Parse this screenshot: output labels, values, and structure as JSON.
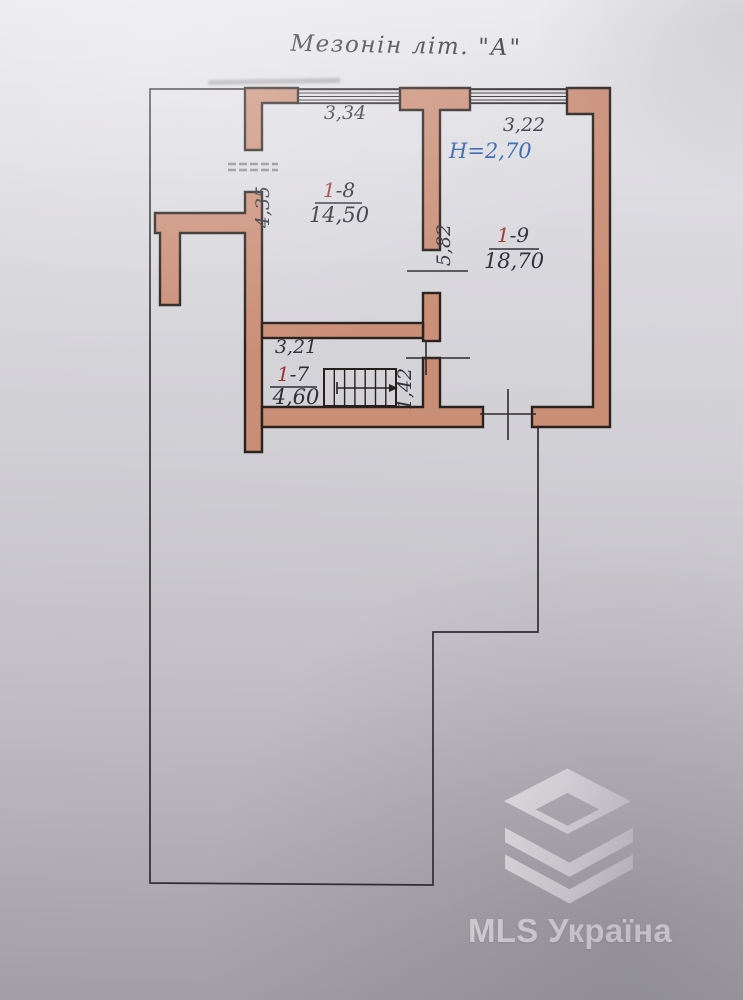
{
  "title": "Мезонін літ. \"А\"",
  "rooms": [
    {
      "name": "room-1-8",
      "number_prefix": "1",
      "number_suffix": "-8",
      "area": "14,50"
    },
    {
      "name": "room-1-9",
      "number_prefix": "1",
      "number_suffix": "-9",
      "area": "18,70"
    },
    {
      "name": "room-1-7",
      "number_prefix": "1",
      "number_suffix": "-7",
      "area": "4,60"
    }
  ],
  "labels": {
    "ceiling_height": "H=2,70"
  },
  "dimensions": {
    "room8_width": "3,34",
    "room9_width": "3,22",
    "room8_left_wall": "4,35",
    "inner_wall": "5,82",
    "room7_width": "3,21",
    "stair_opening": "1,42"
  },
  "watermark": {
    "brand": "MLS Україна"
  },
  "colors": {
    "wall_fill": "#cb8f77",
    "wall_outline": "#29221f",
    "paper": "#d6d5da",
    "accent_room_number": "#9e3330",
    "height_text": "#2a5ca8",
    "dimension_text": "#33313a"
  }
}
